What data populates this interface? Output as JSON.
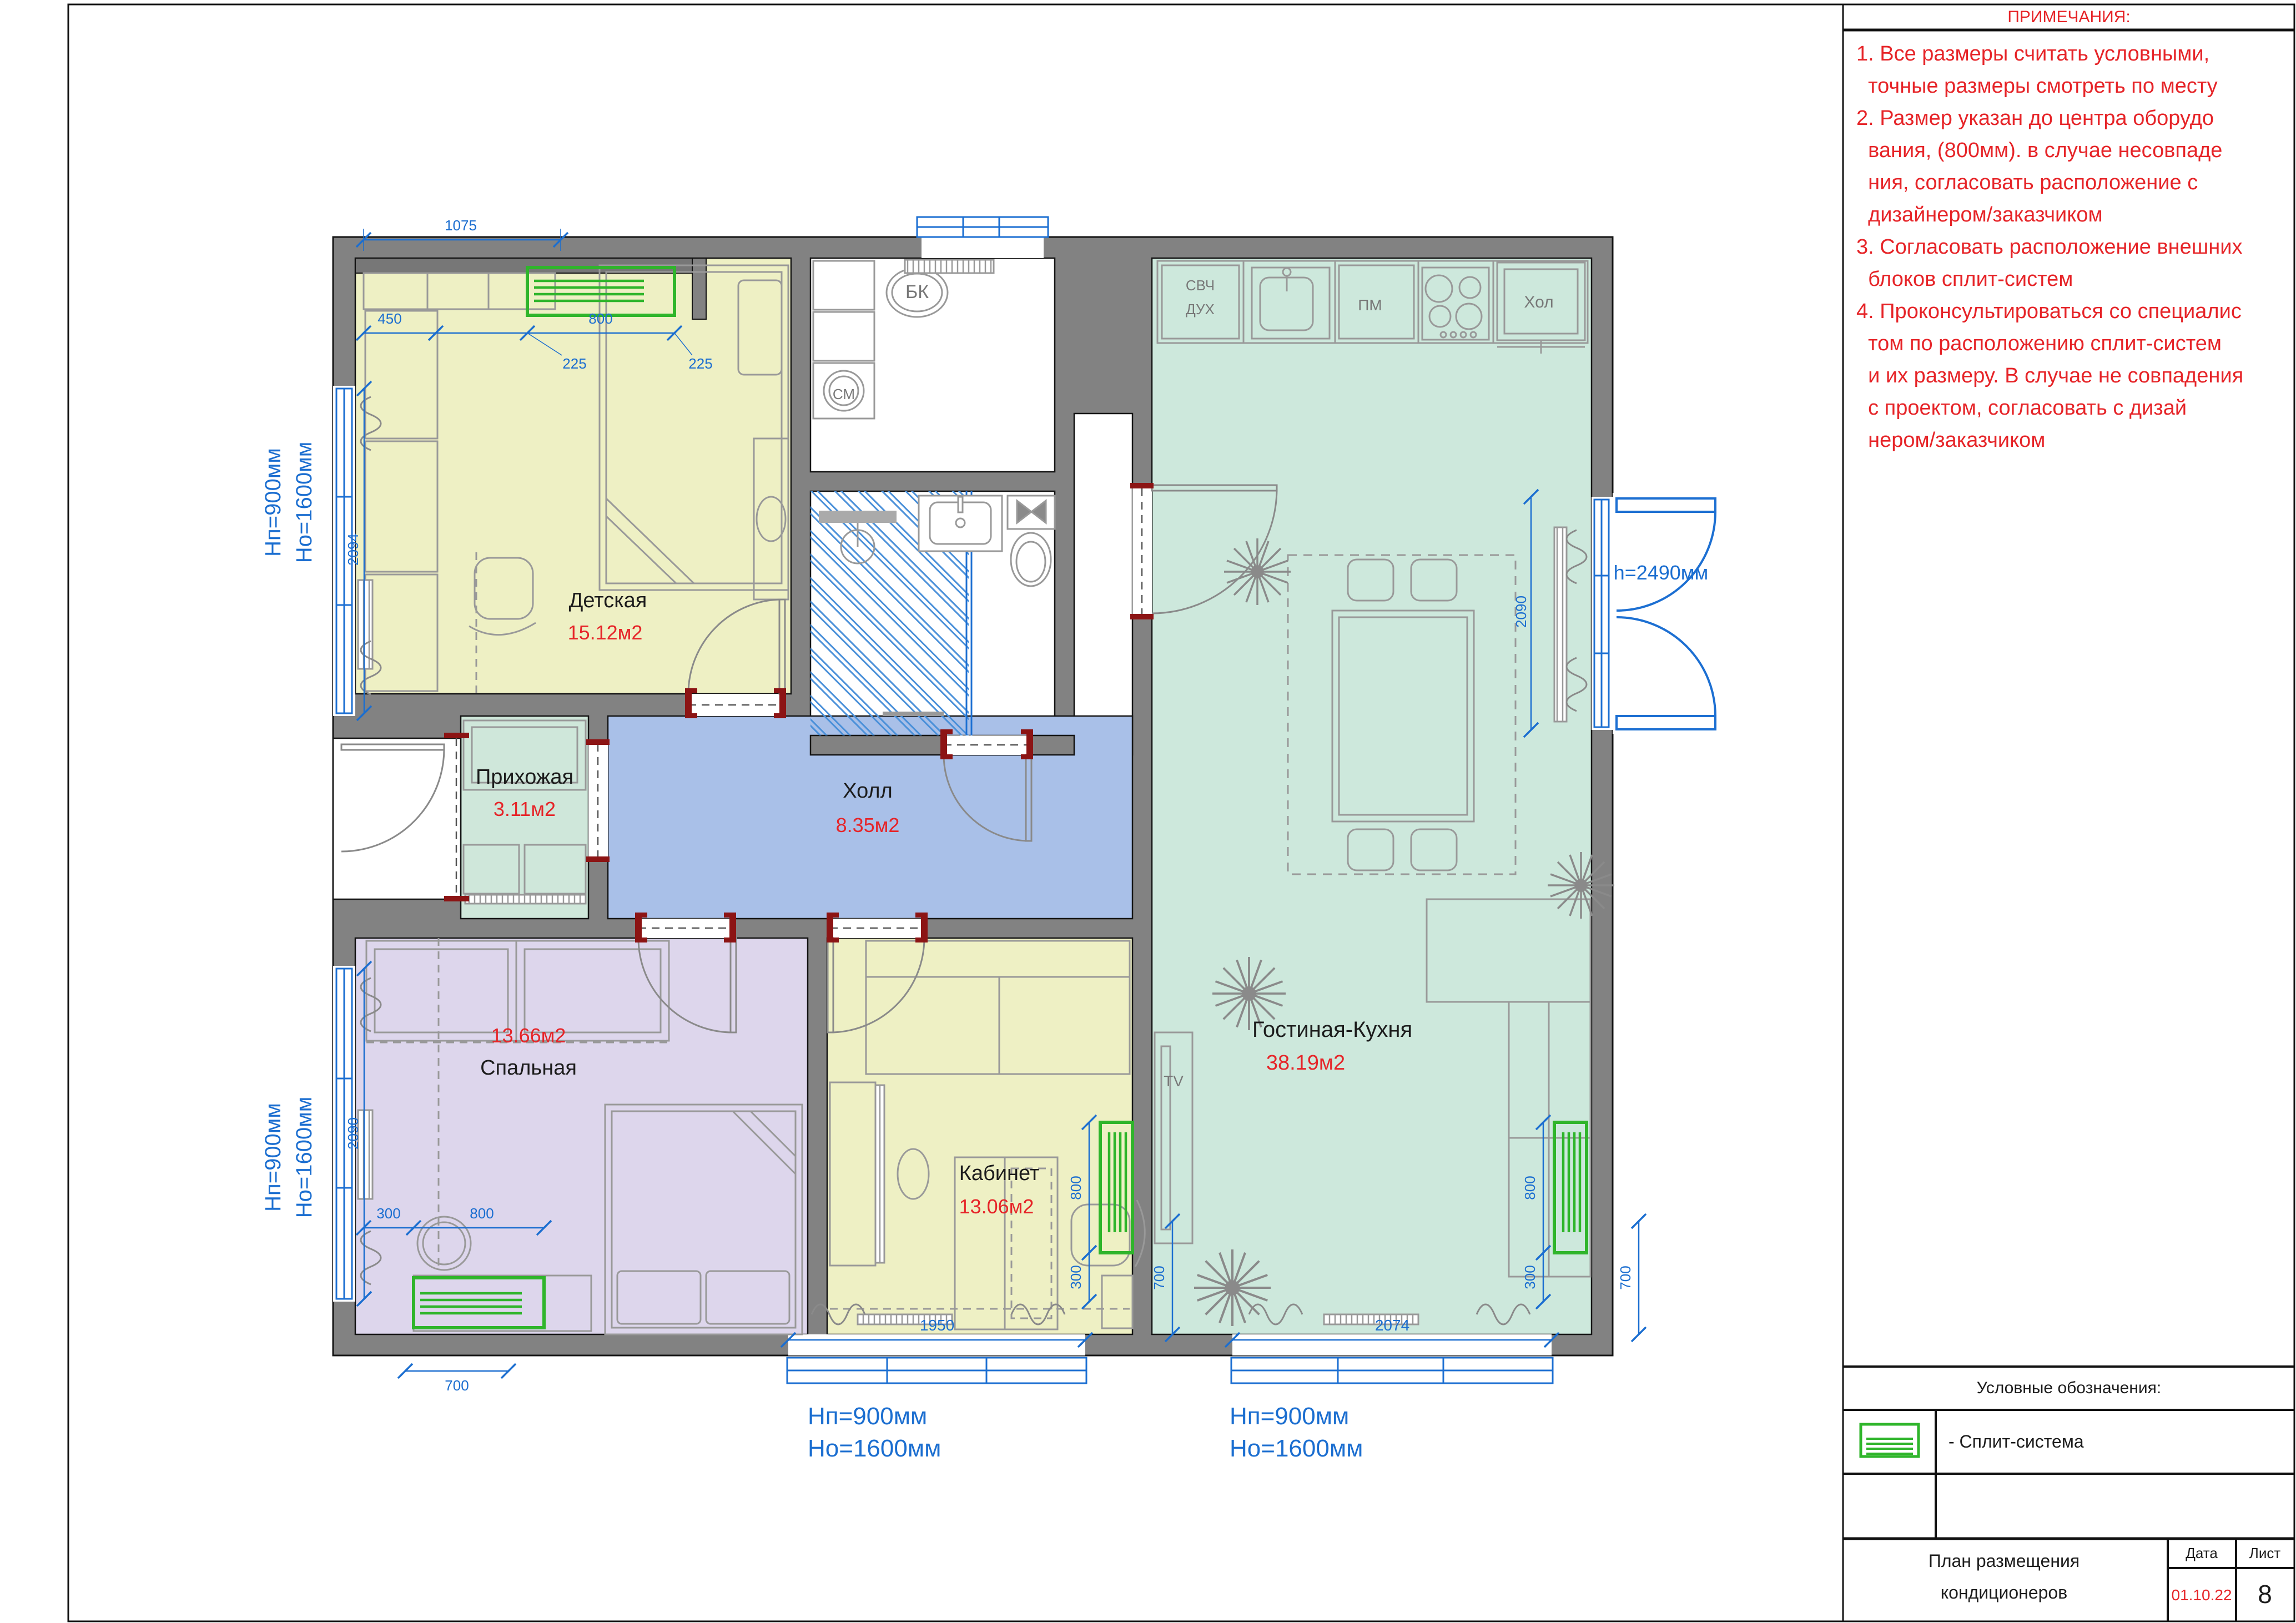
{
  "sheet": {
    "notes": {
      "title": "ПРИМЕЧАНИЯ:",
      "lines": [
        "1. Все размеры считать условными,",
        "  точные размеры смотреть по месту",
        "2. Размер указан до центра оборудо",
        "  вания, (800мм). в случае несовпаде",
        "  ния, согласовать расположение с",
        "  дизайнером/заказчиком",
        "3. Согласовать расположение внешних",
        "  блоков сплит-систем",
        "4. Проконсультироваться со специалис",
        "  том по расположению сплит-систем",
        "  и их размеру. В случае не совпадения",
        "  с проектом, согласовать с дизай",
        "  нером/заказчиком"
      ]
    },
    "legend": {
      "title": "Условные обозначения:",
      "item_label": "- Сплит-система"
    },
    "title_block": {
      "title_line1": "План размещения",
      "title_line2": "кондиционеров",
      "date_label": "Дата",
      "sheet_label": "Лист",
      "date_value": "01.10.22",
      "sheet_value": "8"
    }
  },
  "plan": {
    "rooms": [
      {
        "name": "Детская",
        "area": "15.12м2"
      },
      {
        "name": "Прихожая",
        "area": "3.11м2"
      },
      {
        "name": "Холл",
        "area": "8.35м2"
      },
      {
        "name": "Спальная",
        "area": "13.66м2"
      },
      {
        "name": "Кабинет",
        "area": "13.06м2"
      },
      {
        "name": "Гостиная-Кухня",
        "area": "38.19м2"
      }
    ],
    "appliances": {
      "microwave": "СВЧ",
      "oven": "ДУХ",
      "dishwasher": "ПМ",
      "fridge": "Хол",
      "boiler": "БК",
      "washer": "СМ",
      "tv": "TV"
    },
    "dims": {
      "top": "1075",
      "w450": "450",
      "w800": "800",
      "o225a": "225",
      "o225b": "225",
      "win_left_top": "2094",
      "win_left_bottom": "2090",
      "bed300": "300",
      "bed800": "800",
      "bed700": "700",
      "win_bottom_left": "1950",
      "win_bottom_right": "2074",
      "off800": "800",
      "off300": "300",
      "off700": "700",
      "liv800": "800",
      "liv300": "300",
      "liv700": "700",
      "balcony": "2090",
      "balcony_h": "h=2490мм",
      "hp": "Hп=900мм",
      "ho": "Hо=1600мм"
    },
    "colors": {
      "wall": "#828282",
      "children_room": "#eef0c4",
      "hall": "#a9c0e8",
      "bedroom": "#ddd6ec",
      "living": "#cde8dc",
      "dimension_blue": "#1b6ed0",
      "area_red": "#e62428",
      "split_green": "#2fb52b"
    }
  }
}
